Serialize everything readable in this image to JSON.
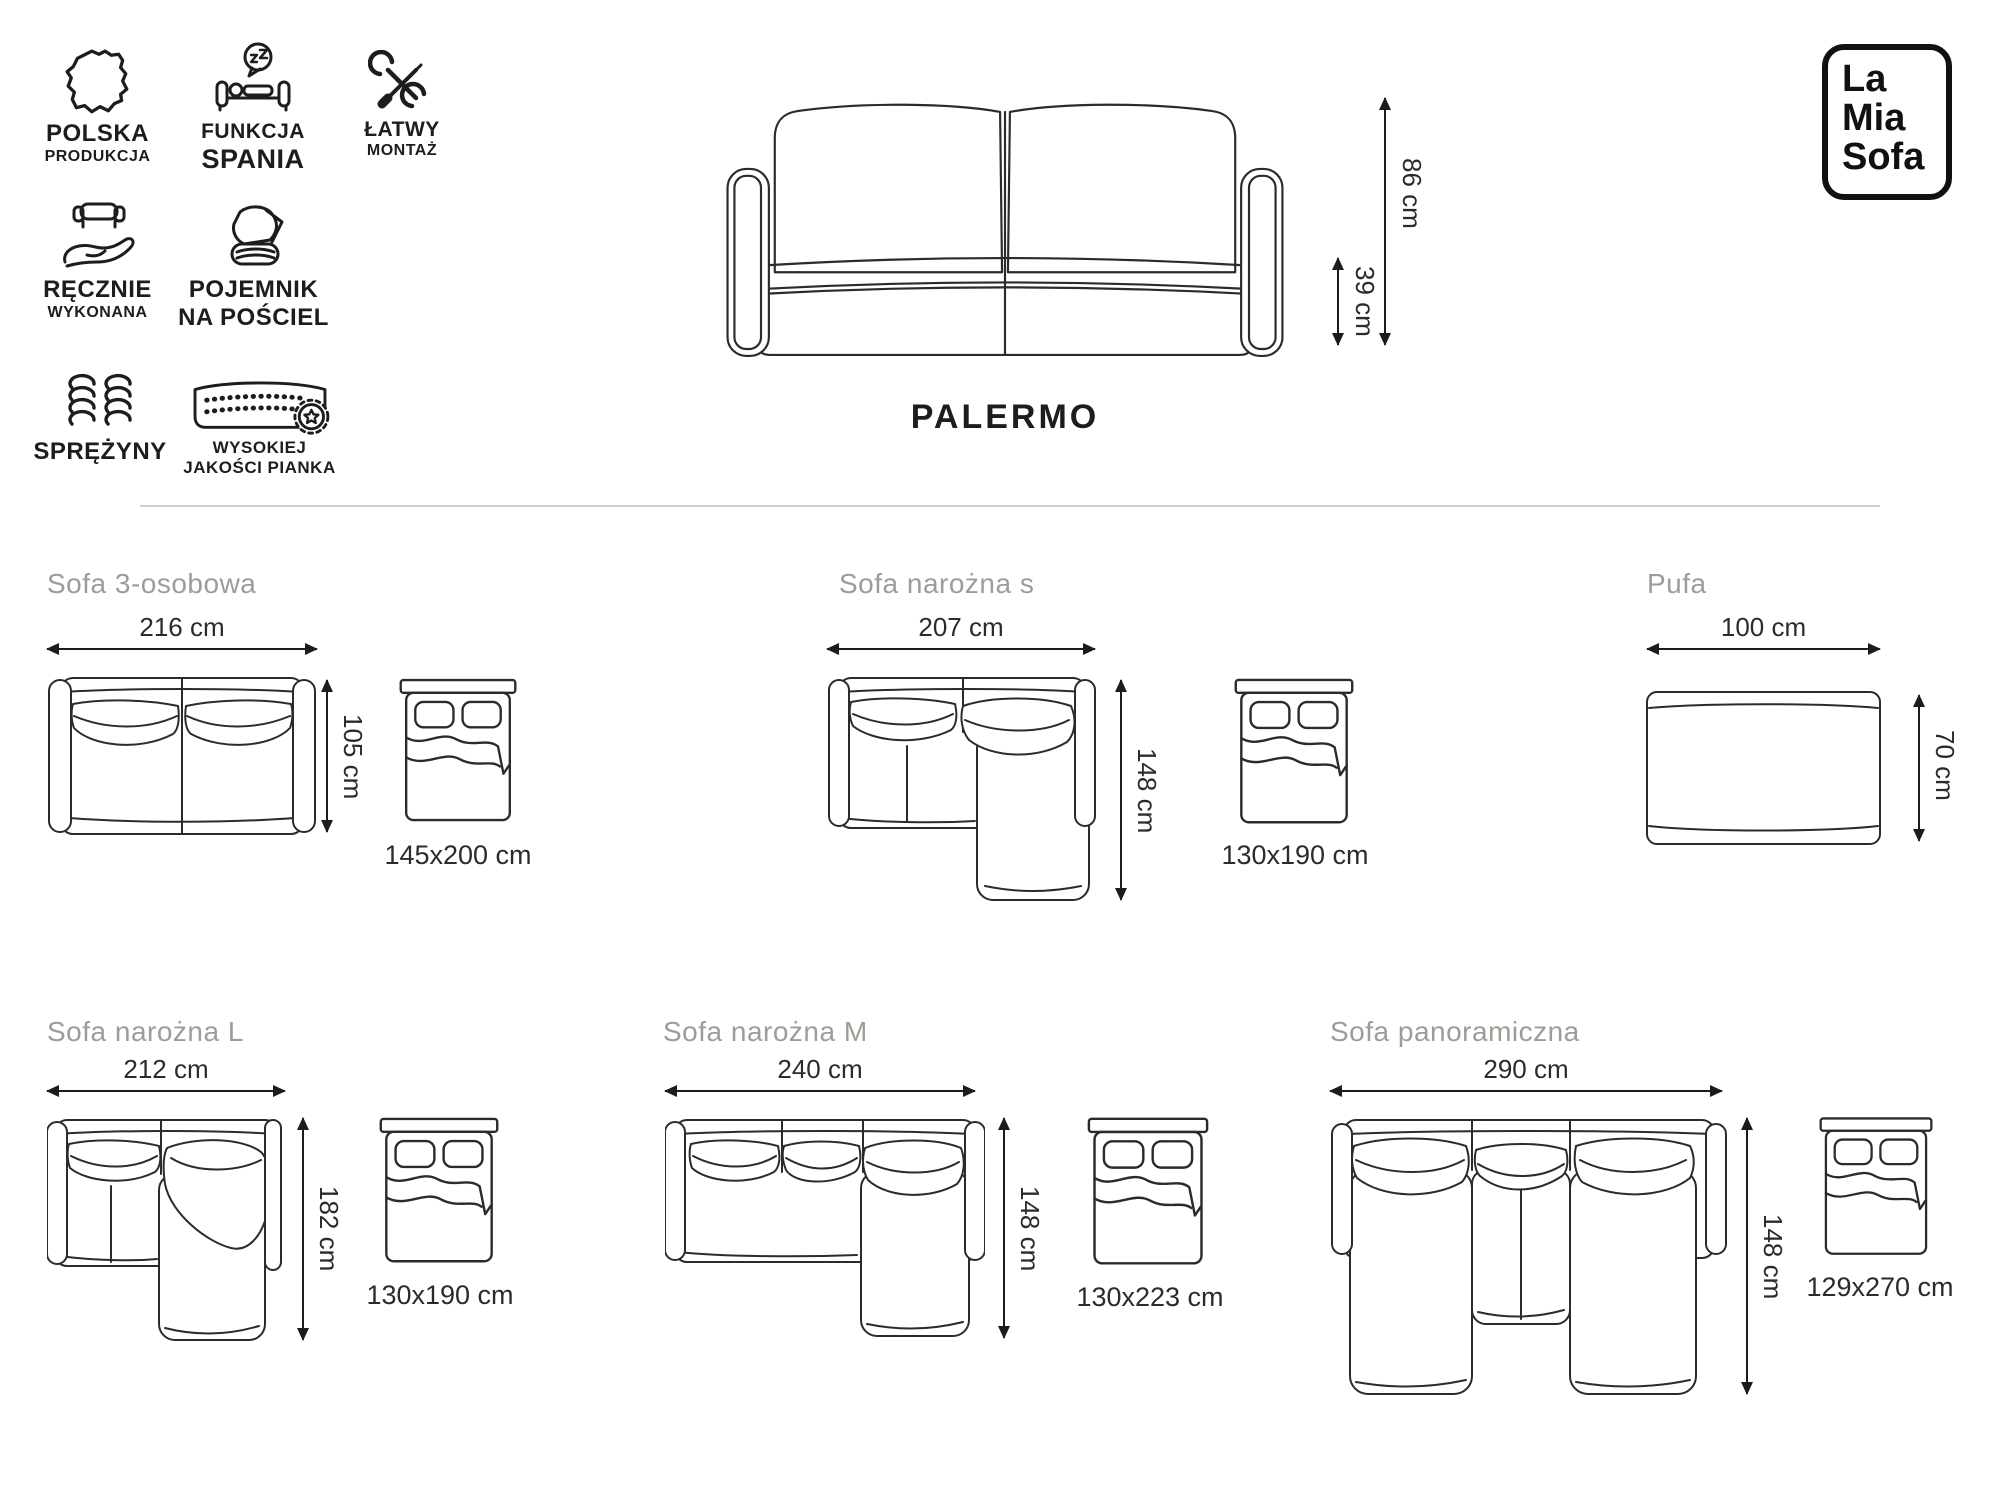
{
  "brand": {
    "line1": "La",
    "line2": "Mia",
    "line3": "Sofa"
  },
  "product": {
    "name": "PALERMO"
  },
  "hero": {
    "icon": "sofa-front-view",
    "total_height": "86 cm",
    "seat_height": "39 cm"
  },
  "features": [
    {
      "id": "polska-produkcja",
      "icon": "poland-map-icon",
      "line1": "POLSKA",
      "line2": "PRODUKCJA"
    },
    {
      "id": "funkcja-spania",
      "icon": "sleeping-function-icon",
      "line1": "FUNKCJA",
      "line2": "SPANIA"
    },
    {
      "id": "latwy-montaz",
      "icon": "tools-icon",
      "line1": "ŁATWY",
      "line2": "MONTAŻ"
    },
    {
      "id": "recznie-wykonana",
      "icon": "handmade-icon",
      "line1": "RĘCZNIE",
      "line2": "WYKONANA"
    },
    {
      "id": "pojemnik-na-posciel",
      "icon": "bedding-storage-icon",
      "line1": "POJEMNIK",
      "line2": "NA POŚCIEL"
    },
    {
      "id": "sprezyny",
      "icon": "springs-icon",
      "line1": "SPRĘŻYNY",
      "line2": ""
    },
    {
      "id": "wysokiej-jakosci-pianka",
      "icon": "foam-quality-icon",
      "line1": "WYSOKIEJ",
      "line2": "JAKOŚCI PIANKA"
    }
  ],
  "variants": [
    {
      "name": "Sofa 3-osobowa",
      "width": "216 cm",
      "depth": "105 cm",
      "bed_size": "145x200 cm"
    },
    {
      "name": "Sofa narożna s",
      "width": "207 cm",
      "depth": "148 cm",
      "bed_size": "130x190 cm"
    },
    {
      "name": "Pufa",
      "width": "100 cm",
      "depth": "70 cm",
      "bed_size": ""
    },
    {
      "name": "Sofa narożna L",
      "width": "212 cm",
      "depth": "182 cm",
      "bed_size": "130x190 cm"
    },
    {
      "name": "Sofa narożna M",
      "width": "240 cm",
      "depth": "148 cm",
      "bed_size": "130x223 cm"
    },
    {
      "name": "Sofa panoramiczna",
      "width": "290 cm",
      "depth": "148 cm",
      "bed_size": "129x270 cm"
    }
  ]
}
